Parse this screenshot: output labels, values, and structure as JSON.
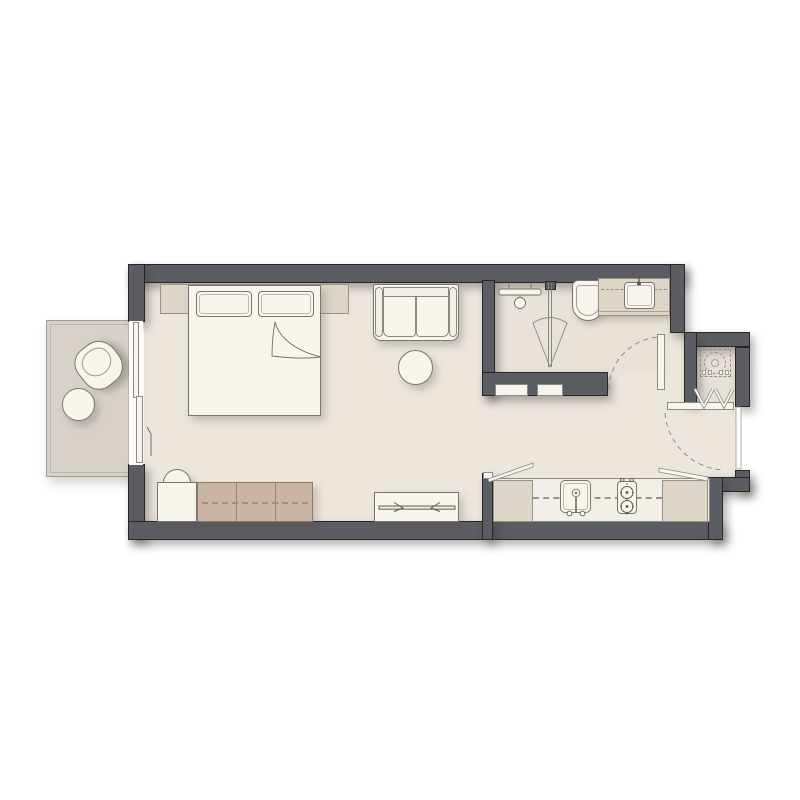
{
  "title": "Studio apartment floor plan",
  "colors": {
    "wall": "#5b5d62",
    "wall_edge": "#26272b",
    "floor_main": "#ece6dd",
    "floor_bath": "#e9e2d9",
    "floor_balcony": "#d8d1ca",
    "floor_niche": "#e7e0d6",
    "furn_white": "#f8f5ee",
    "furn_edge": "#77776f",
    "cabinet_beige": "#ddd5c7",
    "cabinet_edge": "#9a9084",
    "wardrobe_tan": "#cab4a4",
    "wardrobe_edge": "#8d7c6d",
    "wardrobe_dash": "#a88e79",
    "dash": "#8d8d86",
    "line": "#6f6f67",
    "balcony_frame": "#a29c95"
  },
  "rooms": [
    {
      "id": "balcony",
      "symbol": "balcony-with-chair-and-table"
    },
    {
      "id": "main-room",
      "symbol": "combined-living-sleeping-room"
    },
    {
      "id": "bathroom",
      "symbol": "shower-toilet-vanity-room"
    },
    {
      "id": "entry",
      "symbol": "entry-area-with-door-swing"
    },
    {
      "id": "kitchen",
      "symbol": "kitchen-run-along-bottom-wall"
    },
    {
      "id": "utility-niche",
      "symbol": "washer-closet-with-bifold-doors"
    }
  ],
  "symbols": [
    {
      "name": "double-bed-icon",
      "type": "bed with two pillows and folded sheet corner"
    },
    {
      "name": "headboard-icon",
      "type": "headboard panel"
    },
    {
      "name": "loveseat-sofa-icon",
      "type": "two seat sofa"
    },
    {
      "name": "ottoman-icon",
      "type": "round ottoman"
    },
    {
      "name": "wardrobe-icon",
      "type": "three door low cabinet with dashed rail"
    },
    {
      "name": "dresser-chair-icon",
      "type": "dresser with tucked chair"
    },
    {
      "name": "tv-console-icon",
      "type": "media console with wall TV symbol"
    },
    {
      "name": "kitchen-counter-icon",
      "type": "counter with sink and two burner cooktop"
    },
    {
      "name": "washing-machine-icon",
      "type": "dashed drum outline in niche"
    },
    {
      "name": "bifold-door-icon",
      "type": "double V accordion door"
    },
    {
      "name": "door-swing-icon",
      "type": "dashed quarter-circle arcs"
    },
    {
      "name": "shower-head-icon",
      "type": "shower fixture with spray fan"
    },
    {
      "name": "glass-screen-icon",
      "type": "double line shower partition"
    },
    {
      "name": "toilet-icon",
      "type": "wall hung toilet"
    },
    {
      "name": "vanity-sink-icon",
      "type": "counter basin with faucet"
    },
    {
      "name": "balcony-chair-icon",
      "type": "rotated armchair"
    },
    {
      "name": "balcony-table-icon",
      "type": "round side table"
    },
    {
      "name": "sliding-door-icon",
      "type": "two panel balcony slider"
    }
  ]
}
